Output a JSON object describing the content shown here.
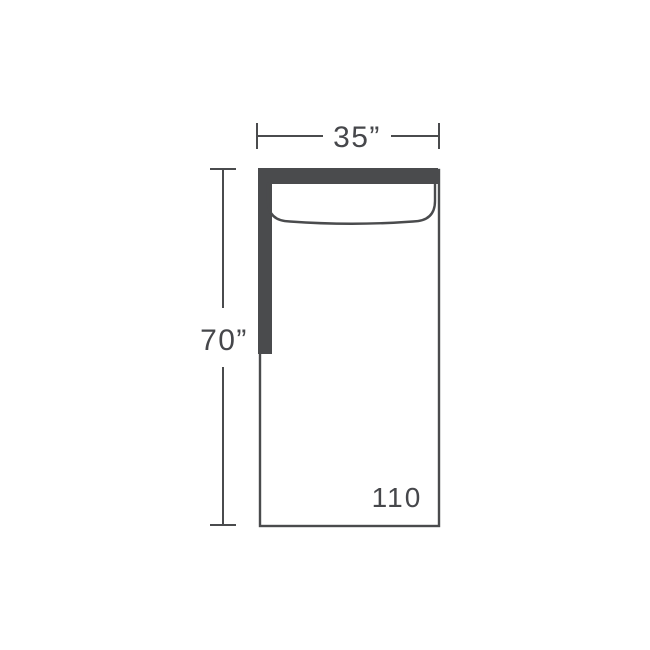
{
  "diagram": {
    "width_label": "35”",
    "depth_label": "70”",
    "product_code": "110",
    "colors": {
      "line": "#4a4b4d",
      "text": "#46474b",
      "background": "#ffffff"
    }
  }
}
